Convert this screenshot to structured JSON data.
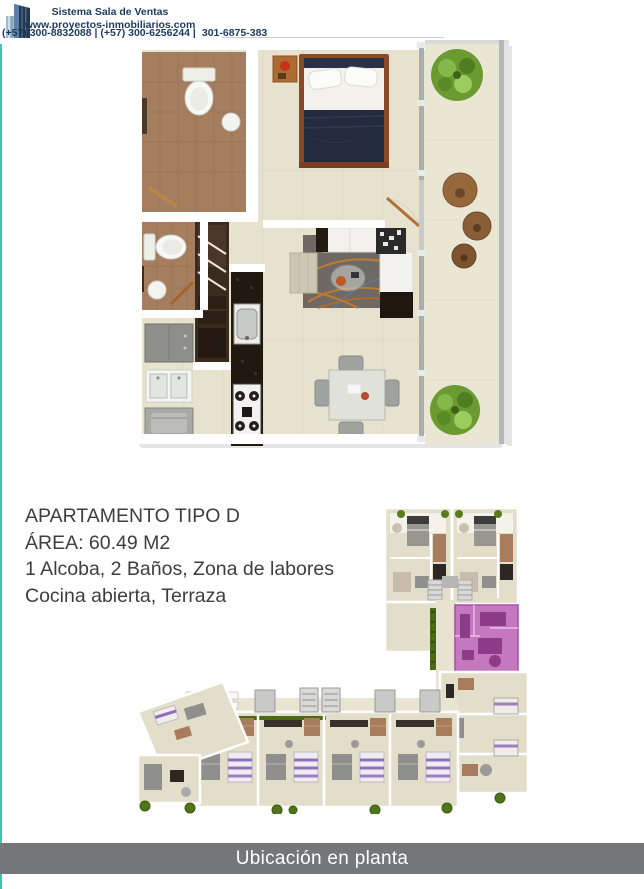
{
  "header": {
    "brand": "Sistema Sala de Ventas",
    "website": "www.proyectos-inmobiliarios.com",
    "phones": "(+57) 300-8832088  | (+57) 300-6256244 |",
    "whatsapp": "301-6875-383"
  },
  "apartment": {
    "title": "APARTAMENTO TIPO D",
    "area_label": "ÁREA: 60.49 M2",
    "features": [
      "1 Alcoba, 2 Baños, Zona de labores",
      "Cocina abierta, Terraza"
    ]
  },
  "plans": {
    "apartment_render": "apartment-type-d-3d-floorplan",
    "location_plan": "building-floor-location-plan",
    "highlighted_unit": "tipo-d-unit-highlight"
  },
  "footer": {
    "caption": "Ubicación en planta"
  },
  "colors": {
    "accent_teal": "#41C4B1",
    "footer_bar_gray": "#75767A",
    "brand_navy": "#1C3A5E",
    "whatsapp_green": "#2BB741",
    "unit_highlight_purple": "#C478BE",
    "plan_floor_beige": "#E7E2CE",
    "text_gray": "#3E3E3E"
  }
}
